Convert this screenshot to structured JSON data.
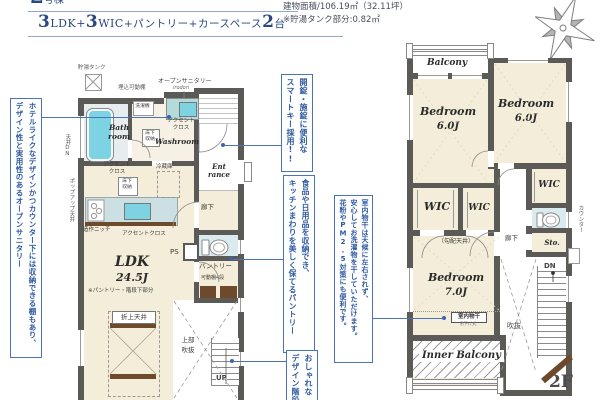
{
  "colors": {
    "title_navy": "#2a4780",
    "note_blue": "#2e5aa0",
    "note_border": "#4a74b5",
    "wall_gray": "#5c5a57",
    "floor_cream": "#f3edd9",
    "fixture_cyan": "#7ed3e2",
    "counter_teal": "#b5dbd8",
    "toilet_blue": "#d9ebee",
    "wood_brown": "#6e4a2c"
  },
  "header": {
    "lot_number": "2",
    "lot_unit": "号棟",
    "plan": {
      "n1": "3",
      "u1": "LDK",
      "plus1": "+",
      "n2": "3",
      "u2": "WIC",
      "mid": "+パントリー+カースペース",
      "n3": "2",
      "tail": "台"
    },
    "area_line1": "建物面積/106.19㎡（32.11坪）",
    "area_line2": "※貯湯タンク部分:0.82㎡"
  },
  "notes": {
    "sanitary1": "ホテルライクなデザインかつカウンター下には収納できる棚もあり、",
    "sanitary2": "デザイン性と実用性のあるオープンサニタリー",
    "smartkey1": "開錠・施錠に便利な",
    "smartkey2": "スマートキー採用!!",
    "pantry1": "食品や日用品を収納でき、",
    "pantry2": "キッチンまわりを美しく保てるパントリー",
    "stairs1": "おしゃれな",
    "stairs2": "デザイン階段",
    "drying1": "室内物干は天候に左右されず、",
    "drying2": "安心してお洗濯物を干していただけます。",
    "drying3": "花粉やPM2.5対策にも便利です。"
  },
  "f1": {
    "tank": "貯湯タンク",
    "recessed_shelf": "埋込可動棚",
    "open_sanitary": "オープンサニタリー",
    "open_sanitary_sub": "irodori",
    "washer": "洗濯機",
    "bath1": "Bath",
    "bath2": "room",
    "washroom": "Washroom",
    "underfloor1": "床下",
    "underfloor2": "収納",
    "accent1": "アクセント",
    "accent2": "クロス",
    "accent_single": "アクセントクロス",
    "fridge": "冷蔵庫",
    "niche": "造作ニッチ",
    "ceiling_dn": "天井DN",
    "popup_ceiling": "ポップアップ天井",
    "ent1": "Ent",
    "ent2": "rance",
    "hall": "廊下",
    "ps": "PS",
    "pantry": "パントリー",
    "shelf4": "可動棚4段",
    "ldk": "LDK",
    "ldk_size": "24.5J",
    "ldk_note": "※パントリー・階段下部分",
    "raised_ceiling": "折上天井",
    "void1": "上部",
    "void2": "吹抜",
    "up": "UP"
  },
  "f2": {
    "balcony": "Balcony",
    "bedroom": "Bedroom",
    "size_b1": "6.0J",
    "size_b2": "6.0J",
    "size_b3": "7.0J",
    "wic": "WIC",
    "counter": "カウンター",
    "hall": "廊下",
    "sto": "Sto.",
    "sloped_ceiling": "（勾配天井）",
    "drying_label": "室内物干",
    "drying_type": "吊下げ式",
    "inner_balcony": "Inner Balcony",
    "void": "吹抜",
    "dn": "DN",
    "floor_tag": "2F"
  }
}
